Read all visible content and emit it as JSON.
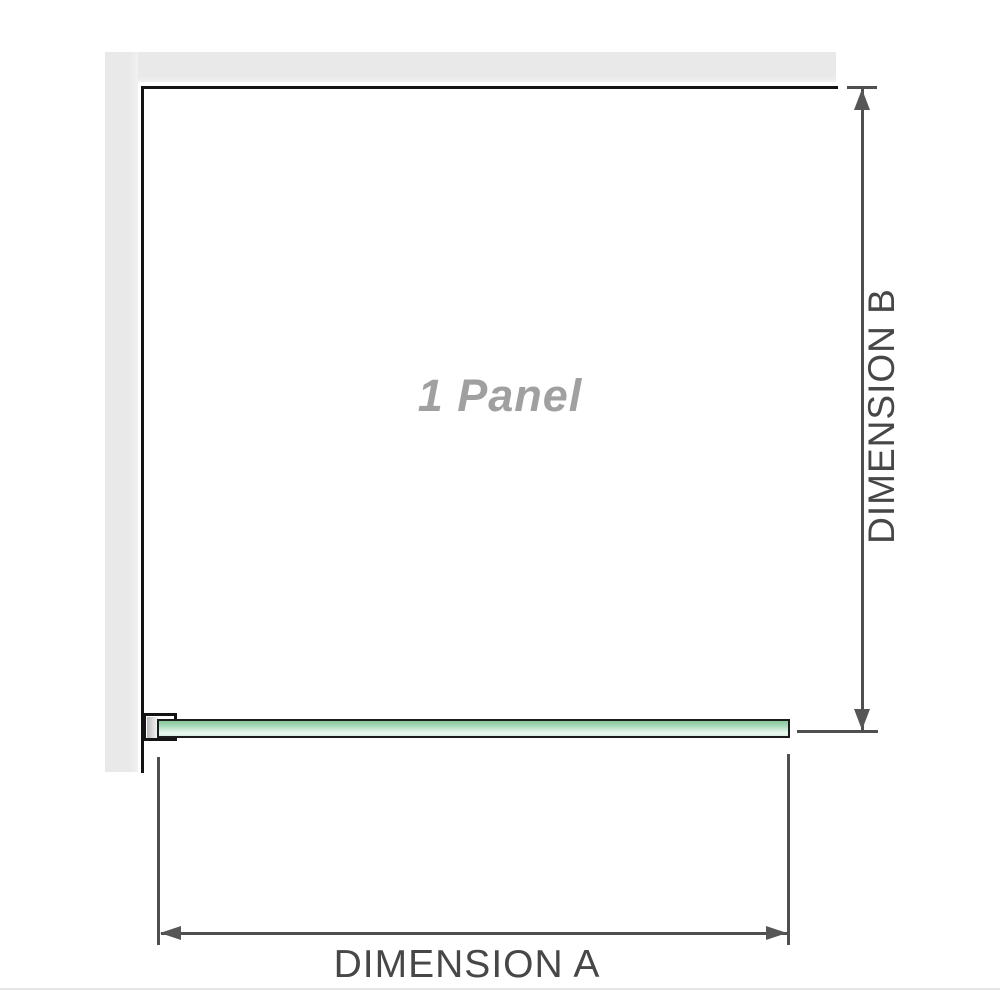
{
  "diagram": {
    "panel_label": "1 Panel",
    "dimension_a": {
      "label": "DIMENSION A",
      "orientation": "horizontal"
    },
    "dimension_b": {
      "label": "DIMENSION B",
      "orientation": "vertical"
    },
    "colors": {
      "wall": "#e9e9e9",
      "outline": "#141414",
      "dimension_line": "#4f4f4f",
      "arrowhead": "#565656",
      "label_text": "#474747",
      "panel_label_text": "#a0a0a0",
      "glass_green_dark": "#86c89c",
      "glass_green_light": "#eef9f3",
      "separator": "#e5e5e5"
    }
  }
}
